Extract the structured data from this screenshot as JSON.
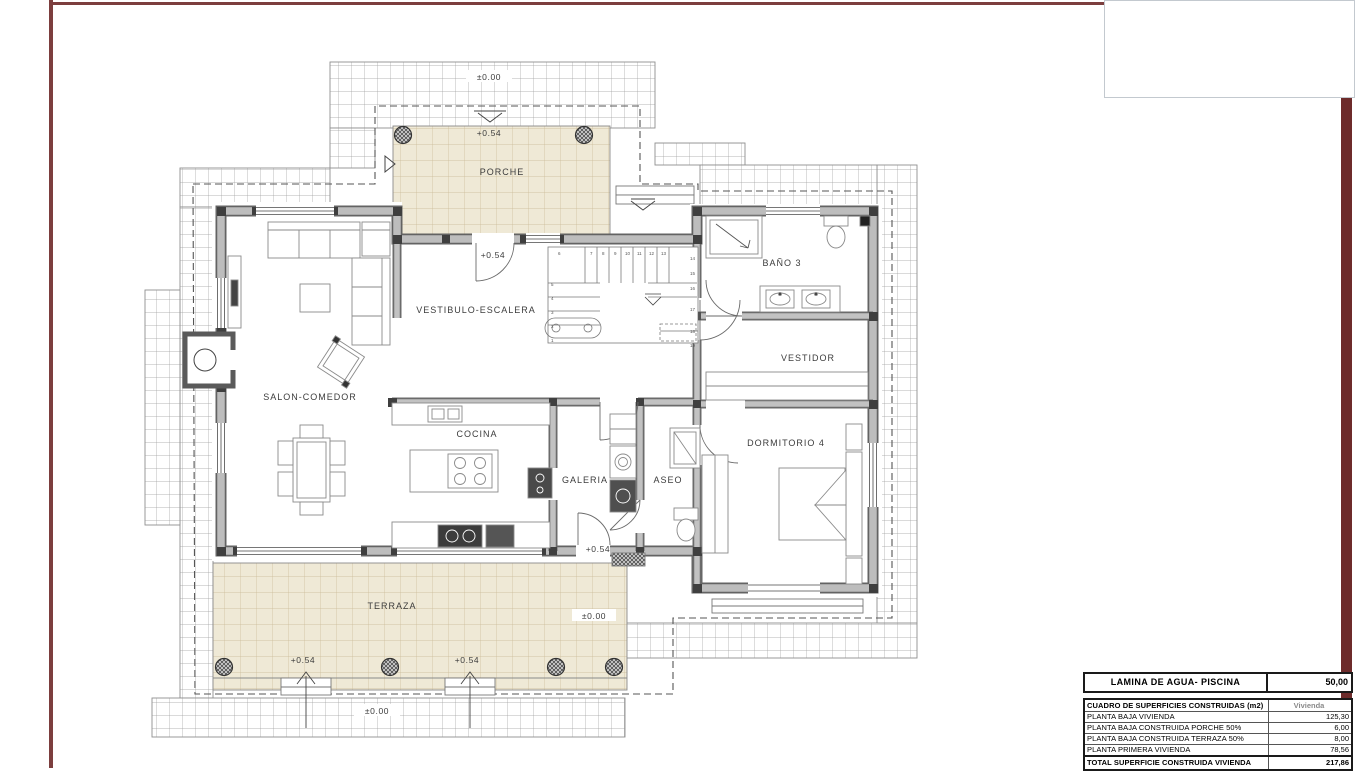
{
  "plan": {
    "rooms": {
      "porche": "PORCHE",
      "vestibulo": "VESTIBULO-ESCALERA",
      "salon": "SALON-COMEDOR",
      "cocina": "COCINA",
      "galeria": "GALERIA",
      "aseo": "ASEO",
      "bano3": "BAÑO 3",
      "vestidor": "VESTIDOR",
      "dormitorio4": "DORMITORIO 4",
      "terraza": "TERRAZA"
    },
    "elevations": {
      "ground_top": "±0.00",
      "porch": "+0.54",
      "entry": "+0.54",
      "galeria_exit": "+0.54",
      "terraza_step_left": "+0.54",
      "terraza_step_right": "+0.54",
      "ground_bottom": "±0.00",
      "ground_right": "±0.00"
    },
    "stairs": {
      "numbers": [
        "1",
        "2",
        "3",
        "4",
        "5",
        "6",
        "7",
        "8",
        "9",
        "10",
        "11",
        "12",
        "13",
        "14",
        "15",
        "16",
        "17",
        "18",
        "19"
      ]
    }
  },
  "tables": {
    "piscina": {
      "label": "LAMINA DE AGUA- PISCINA",
      "value": "50,00"
    },
    "superficies": {
      "header": "CUADRO DE SUPERFICIES CONSTRUIDAS (m2)",
      "header_value": "Vivienda",
      "rows": [
        {
          "label": "PLANTA BAJA VIVIENDA",
          "value": "125,30"
        },
        {
          "label": "PLANTA BAJA CONSTRUIDA PORCHE 50%",
          "value": "6,00"
        },
        {
          "label": "PLANTA BAJA CONSTRUIDA TERRAZA 50%",
          "value": "8,00"
        },
        {
          "label": "PLANTA PRIMERA VIVIENDA",
          "value": "78,56"
        }
      ],
      "total_label": "TOTAL SUPERFICIE CONSTRUIDA VIVIENDA",
      "total_value": "217,86"
    }
  }
}
